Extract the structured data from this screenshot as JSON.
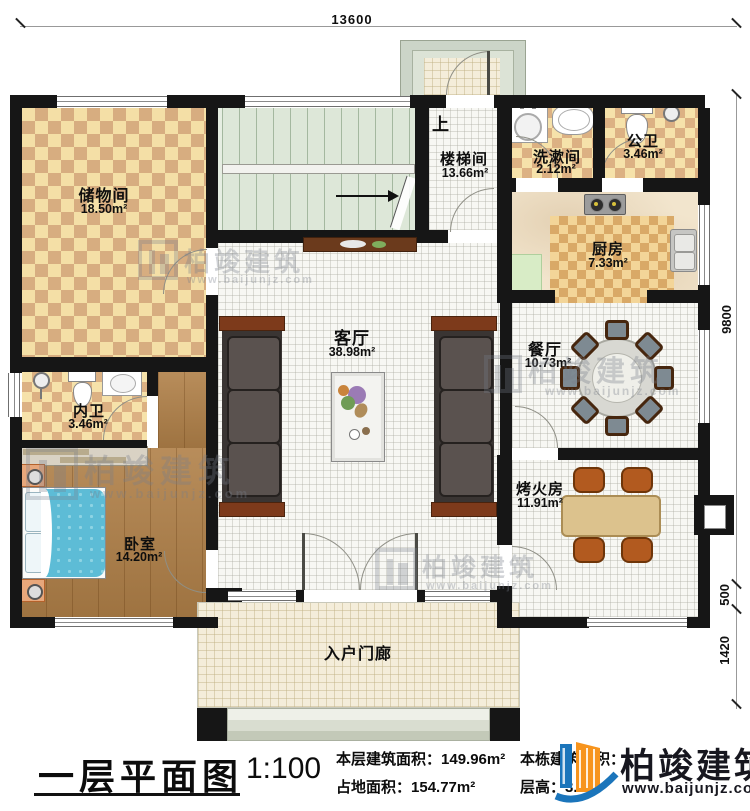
{
  "dimensions": {
    "top": "13600",
    "right_main": "9800",
    "right_mid": "500",
    "right_porch": "1420"
  },
  "rooms": {
    "storage": {
      "name": "储物间",
      "area": "18.50m²"
    },
    "stair": {
      "name": "楼梯间",
      "area": "13.66m²"
    },
    "up": "上",
    "wash": {
      "name": "洗漱间",
      "area": "2.12m²"
    },
    "pubbath": {
      "name": "公卫",
      "area": "3.46m²"
    },
    "kitchen": {
      "name": "厨房",
      "area": "7.33m²"
    },
    "dining": {
      "name": "餐厅",
      "area": "10.73m²"
    },
    "living": {
      "name": "客厅",
      "area": "38.98m²"
    },
    "enbath": {
      "name": "内卫",
      "area": "3.46m²"
    },
    "bedroom": {
      "name": "卧室",
      "area": "14.20m²"
    },
    "fire": {
      "name": "烤火房",
      "area": "11.91m²"
    },
    "porch": {
      "name": "入户门廊"
    }
  },
  "titleblock": {
    "title": "一层平面图",
    "scale": "1:100",
    "floor_area_label": "本层建筑面积：",
    "floor_area_value": "149.96m²",
    "site_area_label": "占地面积：",
    "site_area_value": "154.77m²",
    "total_area_label": "本栋建筑面积：",
    "height_label": "层高：",
    "height_value": "3.0m"
  },
  "brand": {
    "name": "柏竣建筑",
    "url": "www.baijunjz.com"
  },
  "colors": {
    "wall": "#161616",
    "brand_blue": "#1b75bb",
    "brand_orange": "#f7941d"
  }
}
